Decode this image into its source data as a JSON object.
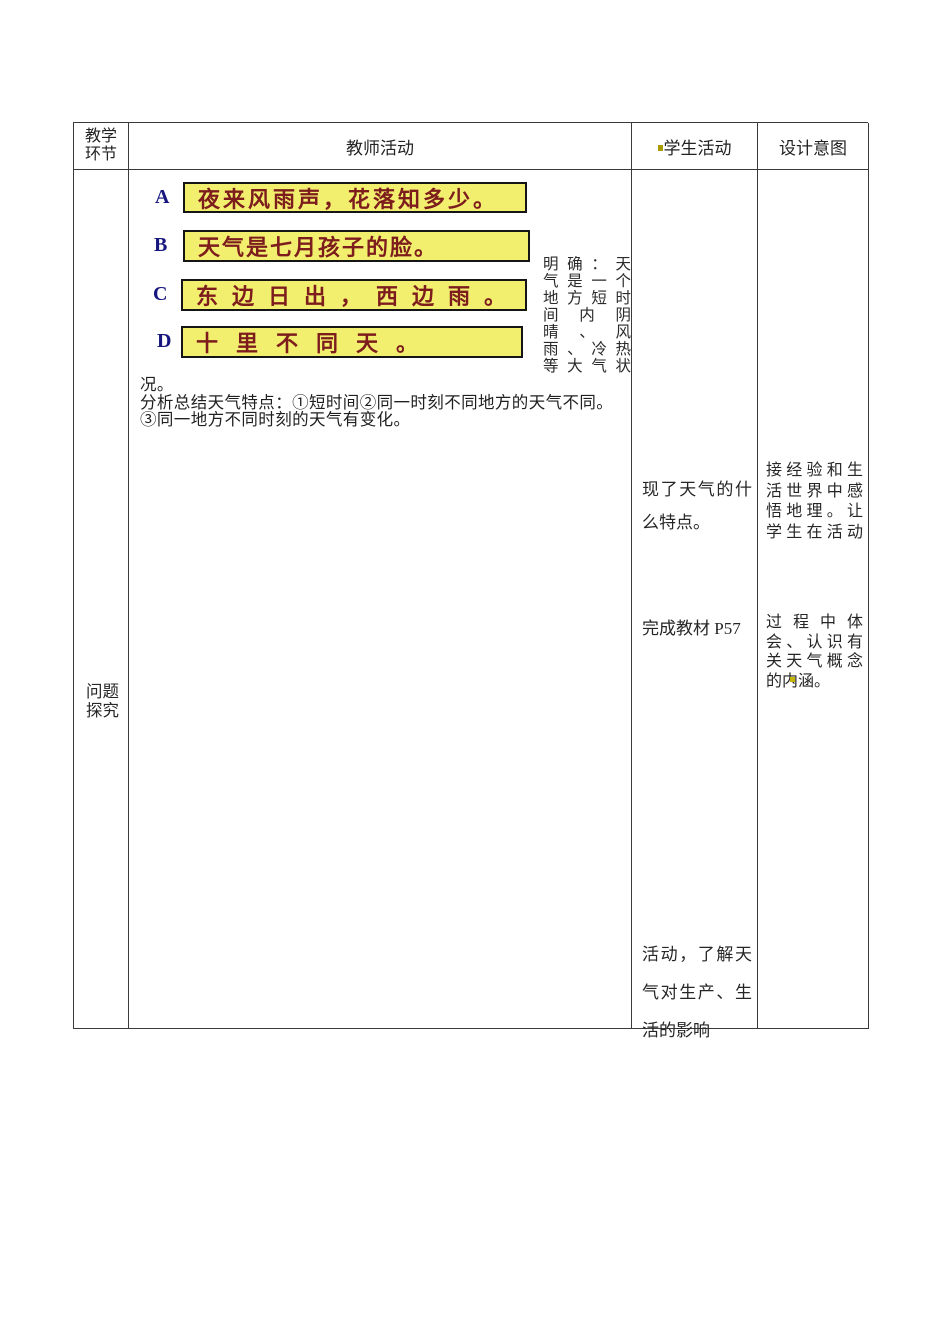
{
  "colors": {
    "table_border": "#3a3a3a",
    "option_box_bg": "#f2ee6e",
    "option_box_border": "#151515",
    "option_text": "#7c1c1c",
    "option_label": "#16167e",
    "body_text": "#262626",
    "artifact_dot": "#a89b00"
  },
  "header": {
    "stage_lines": [
      "教学",
      "环节"
    ],
    "teacher": "教师活动",
    "student": "学生活动",
    "intent": "设计意图"
  },
  "body": {
    "stage_lines": [
      "问题",
      "探究"
    ],
    "teacher": {
      "options": [
        {
          "label": "A",
          "text": "夜来风雨声，花落知多少。"
        },
        {
          "label": "B",
          "text": "天气是七月孩子的脸。"
        },
        {
          "label": "C",
          "text": "东边日出，西边雨。"
        },
        {
          "label": "D",
          "text": "十里不同天。"
        }
      ],
      "side_note_lines": [
        "明确：天",
        "气是一个",
        "地方短时",
        "间内阴",
        "晴、风",
        "雨、冷热",
        "等大气状"
      ],
      "summary_lines": [
        "况。",
        "分析总结天气特点：①短时间②同一时刻不同地方的天气不同。",
        "③同一地方不同时刻的天气有变化。"
      ]
    },
    "student": {
      "block1_lines": [
        "现了天气的什",
        "么特点。"
      ],
      "block2": "完成教材 P57",
      "block3_lines": [
        "活动，了解天",
        "气对生产、生",
        "活的影响"
      ]
    },
    "intent": {
      "block1_lines": [
        "接经验和生",
        "活世界中感",
        "悟地理。让",
        "学生在活动"
      ],
      "block2_lines": [
        "过程中体",
        "会、认识有",
        "关天气概念",
        "的内涵。"
      ]
    }
  }
}
